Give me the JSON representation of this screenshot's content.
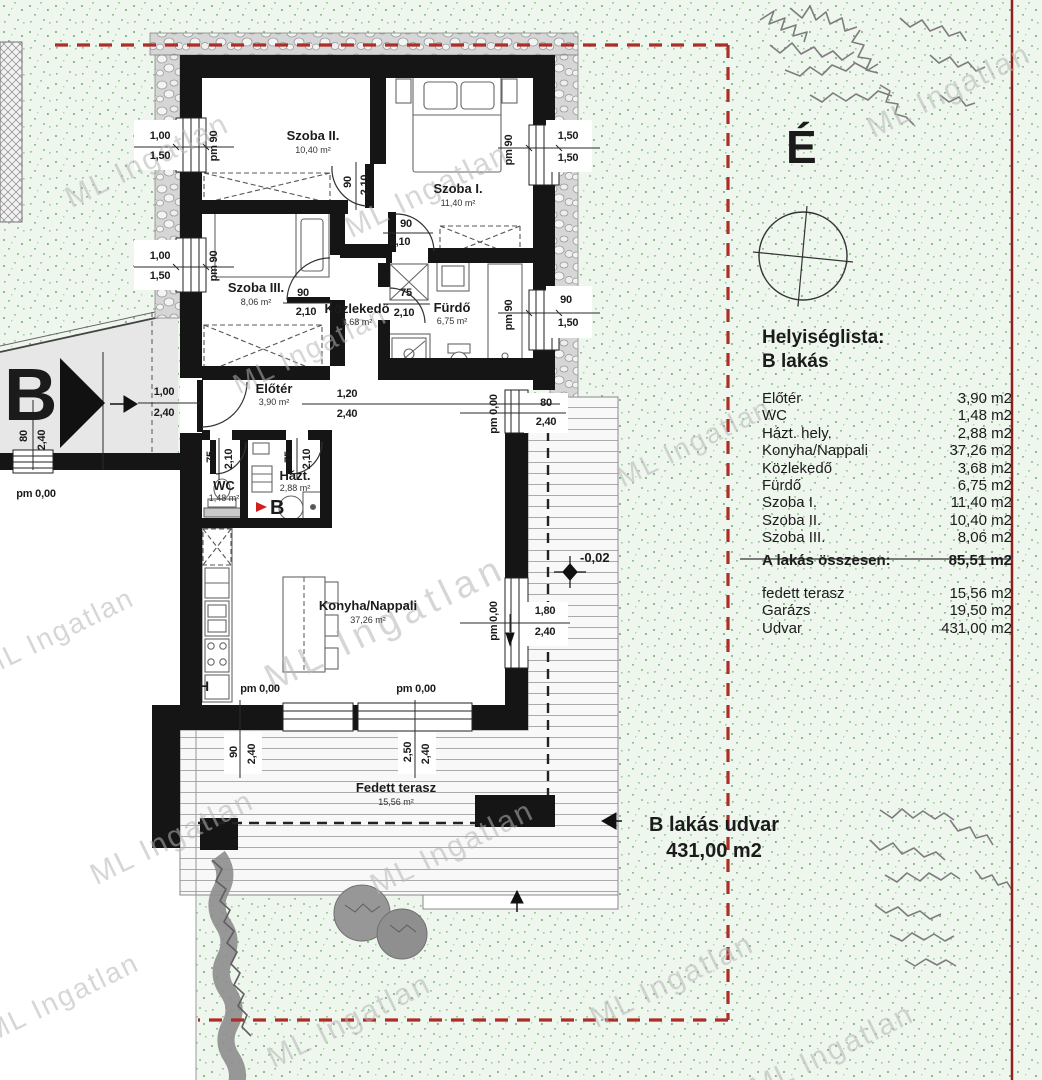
{
  "watermark": {
    "text": "ML Ingatlan"
  },
  "north": {
    "letter": "É"
  },
  "entrance": {
    "letter": "B"
  },
  "markers": {
    "house_b": "B",
    "h": "H",
    "level": "-0,02"
  },
  "yard": {
    "line1": "B lakás udvar",
    "line2": "431,00 m2"
  },
  "rooms": {
    "szoba2": {
      "name": "Szoba II.",
      "area": "10,40 m²"
    },
    "szoba1": {
      "name": "Szoba I.",
      "area": "11,40 m²"
    },
    "szoba3": {
      "name": "Szoba III.",
      "area": "8,06 m²"
    },
    "kozlekedo": {
      "name": "Közlekedő",
      "area": "3,68 m²"
    },
    "furdo": {
      "name": "Fürdő",
      "area": "6,75 m²"
    },
    "eloter": {
      "name": "Előtér",
      "area": "3,90 m²"
    },
    "wc": {
      "name": "WC",
      "area": "1,48 m²"
    },
    "hazt": {
      "name": "Házt.",
      "area": "2,88 m²"
    },
    "konyha": {
      "name": "Konyha/Nappali",
      "area": "37,26 m²"
    },
    "terasz": {
      "name": "Fedett terasz",
      "area": "15,56 m²"
    }
  },
  "dims": {
    "v100": "1,00",
    "v150": "1,50",
    "v90": "90",
    "v210": "2,10",
    "v75": "75",
    "v120": "1,20",
    "v240": "2,40",
    "v80": "80",
    "v180": "1,80",
    "v250": "2,50",
    "pm90": "pm 90",
    "pm000": "pm 0,00"
  },
  "list": {
    "title": "Helyiséglista:",
    "subtitle": "B lakás",
    "rows": [
      {
        "label": "Előtér",
        "value": "3,90 m2"
      },
      {
        "label": "WC",
        "value": "1,48 m2"
      },
      {
        "label": "Házt. hely.",
        "value": "2,88 m2"
      },
      {
        "label": "Konyha/Nappali",
        "value": "37,26 m2"
      },
      {
        "label": "Közlekedő",
        "value": "3,68 m2"
      },
      {
        "label": "Fürdő",
        "value": "6,75 m2"
      },
      {
        "label": "Szoba I.",
        "value": "11,40 m2"
      },
      {
        "label": "Szoba II.",
        "value": "10,40 m2"
      },
      {
        "label": "Szoba III.",
        "value": "8,06 m2"
      }
    ],
    "total_label": "A lakás összesen:",
    "total_value": "85,51 m2",
    "extra": [
      {
        "label": "fedett terasz",
        "value": "15,56 m2"
      },
      {
        "label": "Garázs",
        "value": "19,50 m2"
      },
      {
        "label": "Udvar",
        "value": "431,00 m2"
      }
    ]
  },
  "colors": {
    "boundary_dashed": "#ac2e26",
    "boundary_solid": "#8e1f1a",
    "wall": "#151515",
    "flag_red": "#cf2020",
    "grass_dot": "#8cc08c"
  }
}
